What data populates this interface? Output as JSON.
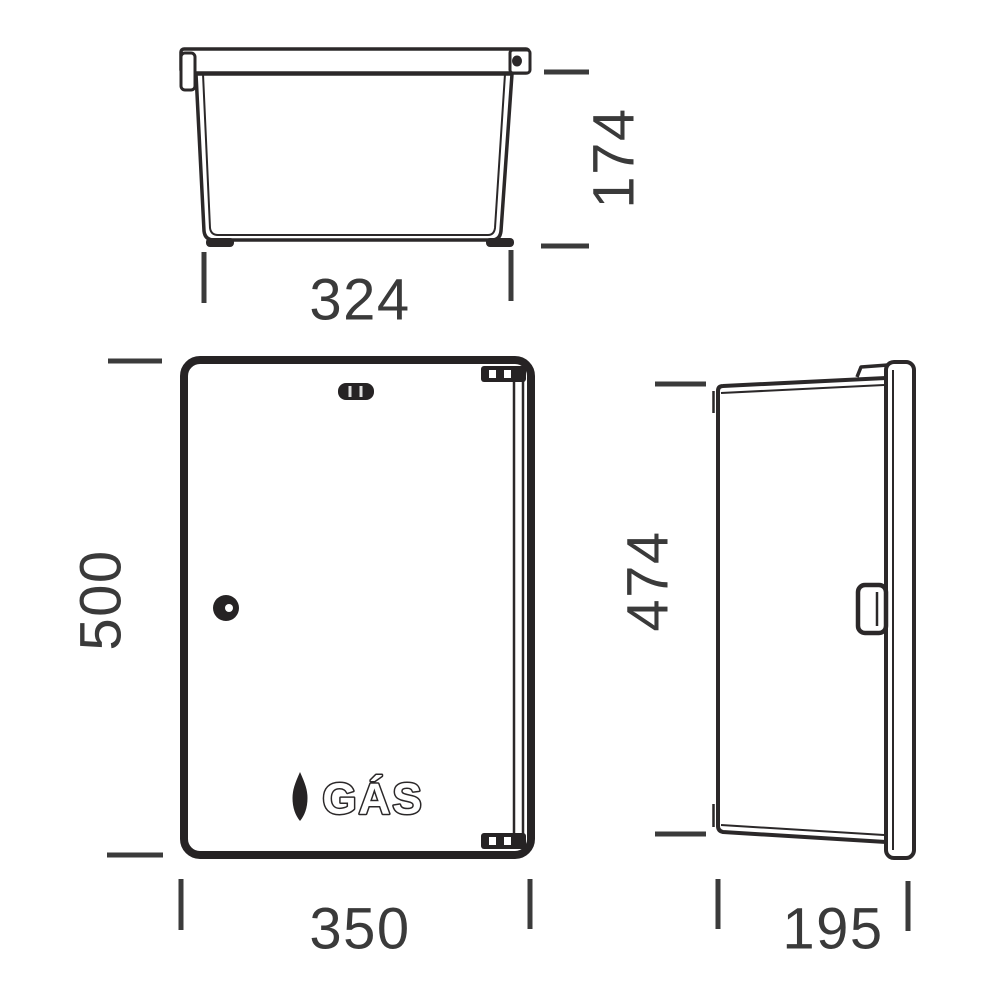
{
  "diagram": {
    "background_color": "#ffffff",
    "line_color": "#2b2829",
    "dimension_color": "#3a3a3a",
    "views": {
      "top_view": {
        "label": "top-view",
        "dimensions": {
          "width": "324",
          "height": "174"
        }
      },
      "front_view": {
        "label": "front-view",
        "dimensions": {
          "width": "350",
          "height": "500"
        },
        "door_marking": {
          "text": "GÁS",
          "icon": "flame-icon"
        }
      },
      "side_view": {
        "label": "side-view",
        "dimensions": {
          "width": "195",
          "height": "474"
        }
      }
    }
  }
}
